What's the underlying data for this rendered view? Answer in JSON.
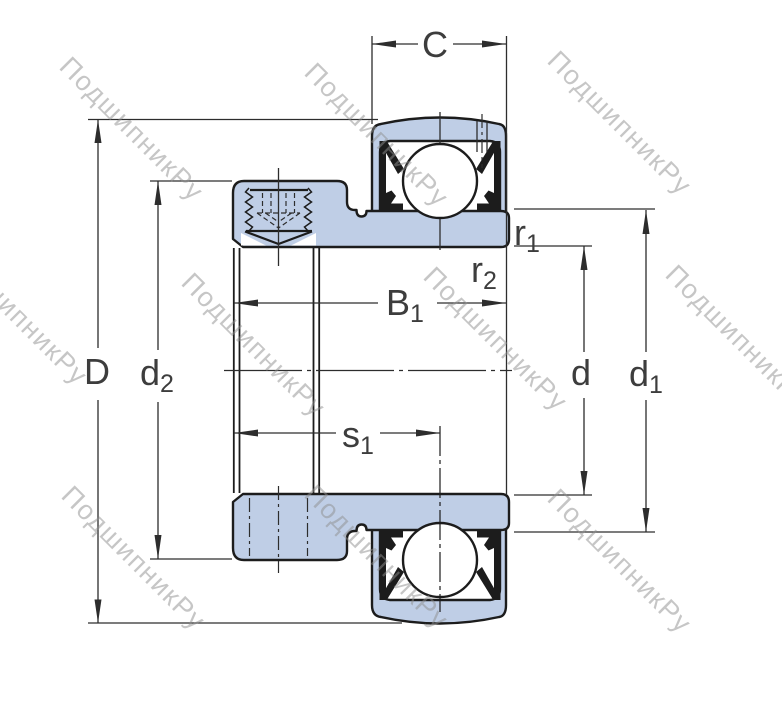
{
  "title": "Insert ball bearing with set screw locking - dimension drawing",
  "watermark": {
    "text": "ПодшипникРу",
    "color": "#8f8f8f"
  },
  "drawing": {
    "fill_color": "#bfcee6",
    "outline_color": "#1c1c1c",
    "dimension_line_color": "#2d2d2d",
    "label_color": "#3d3d3d",
    "labels": {
      "c": {
        "main": "C"
      },
      "D": {
        "main": "D"
      },
      "d2": {
        "main": "d",
        "sub": "2"
      },
      "b1": {
        "main": "B",
        "sub": "1"
      },
      "s1": {
        "main": "s",
        "sub": "1"
      },
      "r1": {
        "main": "r",
        "sub": "1"
      },
      "r2": {
        "main": "r",
        "sub": "2"
      },
      "d": {
        "main": "d"
      },
      "d1": {
        "main": "d",
        "sub": "1"
      }
    }
  }
}
